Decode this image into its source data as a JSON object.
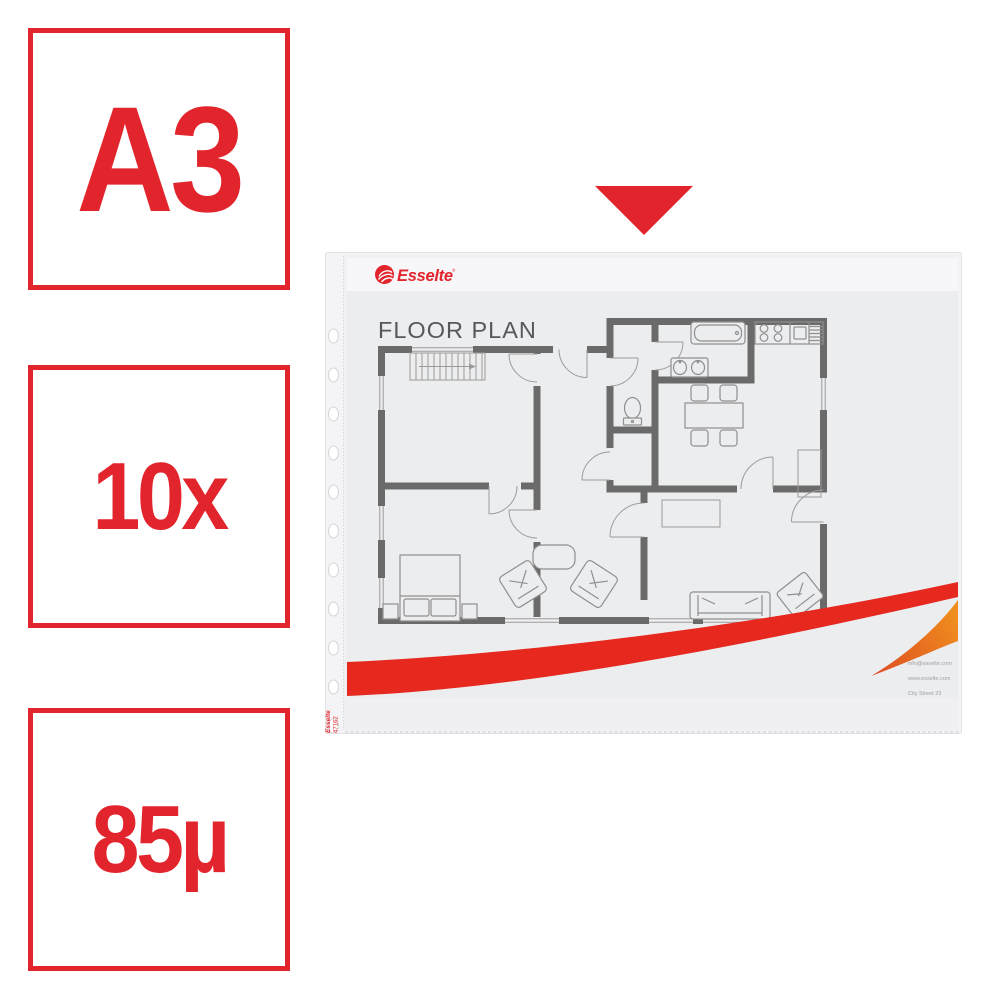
{
  "colors": {
    "badge_red": "#e2242c",
    "swoosh_red": "#e6281e",
    "swoosh_orange_start": "#dd4b22",
    "swoosh_orange_end": "#ef8d1e",
    "wall_gray": "#6a6a6a",
    "furniture_gray": "#8f8f8f",
    "title_gray": "#57585a"
  },
  "badges": [
    {
      "id": "format",
      "label": "A3"
    },
    {
      "id": "quantity",
      "label": "10x"
    },
    {
      "id": "thickness",
      "label": "85µ"
    }
  ],
  "arrow": {
    "type": "down-triangle",
    "color": "#e2242c"
  },
  "pocket": {
    "brand": "Esselte",
    "registered_mark": "®",
    "insert": {
      "title": "FLOOR PLAN",
      "contact_lines": [
        "info@esselte.com",
        "www.esselte.com",
        "City Street 23"
      ]
    },
    "edge_print": {
      "brand": "Esselte",
      "code": "47162"
    }
  }
}
